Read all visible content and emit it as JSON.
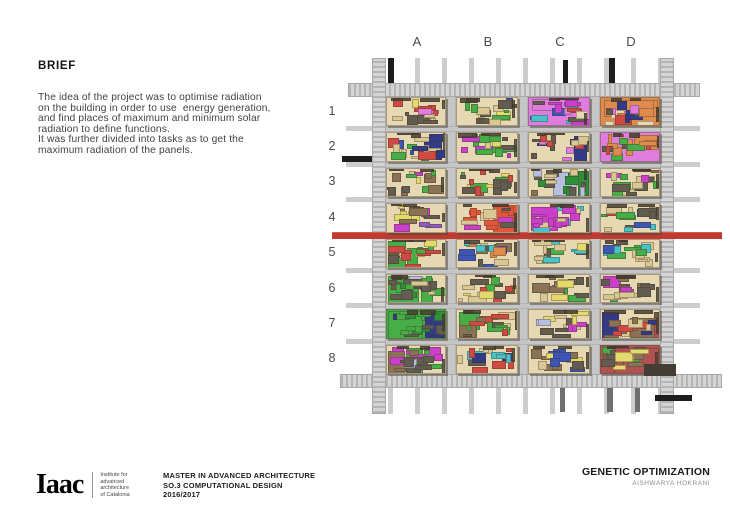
{
  "page": {
    "background": "#ffffff"
  },
  "brief": {
    "heading": "BRIEF",
    "lines": [
      "The idea of the project was to optimise radiation",
      "on the building in order to use  energy generation,",
      "and find places of maximum and minimum solar",
      "radiation to define functions.",
      "It was further divided into tasks as to get the",
      "maximum radiation of the panels."
    ]
  },
  "diagram": {
    "column_labels": [
      "A",
      "B",
      "C",
      "D"
    ],
    "row_labels": [
      "1",
      "2",
      "3",
      "4",
      "5",
      "6",
      "7",
      "8"
    ],
    "colors": {
      "road": "#c6c6c6",
      "road_hatch_dark": "#b5b5b5",
      "road_hatch_light": "#d4d4d4",
      "red_band": "#bf3a31",
      "cell_base": "#e7d8b4",
      "shadow": "#5e574c",
      "black_accent": "#1d1d1d"
    },
    "cells": [
      {
        "id": "A1",
        "base": "#e7d8b4",
        "palette": [
          "#635c50",
          "#cf4a42",
          "#e3d96d",
          "#de7dde",
          "#d9c794",
          "#635c50",
          "#cf4a42"
        ],
        "features": []
      },
      {
        "id": "B1",
        "base": "#e7d8b4",
        "palette": [
          "#d9c794",
          "#3d55b5",
          "#635c50",
          "#e3d96d",
          "#d9c794",
          "#47ad47"
        ],
        "features": []
      },
      {
        "id": "C1",
        "base": "#de7dde",
        "palette": [
          "#cc3fcc",
          "#49c3c9",
          "#3d55b5",
          "#635c50",
          "#de7dde",
          "#e7d8b4",
          "#cf4a42"
        ],
        "features": [
          {
            "x": 0.05,
            "y": 0.05,
            "w": 0.55,
            "h": 0.4,
            "c": "#de7dde",
            "s": 0
          }
        ]
      },
      {
        "id": "D1",
        "base": "#e08b4e",
        "palette": [
          "#e08b4e",
          "#333a85",
          "#cf4a42",
          "#635c50",
          "#e7d8b4",
          "#de7dde"
        ],
        "features": [
          {
            "x": 0.05,
            "y": 0.08,
            "w": 0.9,
            "h": 0.55,
            "c": "#e08b4e",
            "s": 0
          }
        ]
      },
      {
        "id": "A2",
        "base": "#e7d8b4",
        "palette": [
          "#333a85",
          "#3d55b5",
          "#cf4a42",
          "#47ad47",
          "#d9c794",
          "#635c50"
        ],
        "features": [
          {
            "x": 0.62,
            "y": 0.12,
            "w": 0.3,
            "h": 0.8,
            "c": "#333a85",
            "s": 1
          }
        ]
      },
      {
        "id": "B2",
        "base": "#e7d8b4",
        "palette": [
          "#cc3fcc",
          "#47ad47",
          "#e3d96d",
          "#d9c794",
          "#635c50",
          "#47ad47"
        ],
        "features": []
      },
      {
        "id": "C2",
        "base": "#e7d8b4",
        "palette": [
          "#de7dde",
          "#333a85",
          "#cf4a42",
          "#47ad47",
          "#d9c794",
          "#635c50"
        ],
        "features": [
          {
            "x": 0.72,
            "y": 0.08,
            "w": 0.22,
            "h": 0.85,
            "c": "#333a85",
            "s": 1
          }
        ]
      },
      {
        "id": "D2",
        "base": "#de7dde",
        "palette": [
          "#e08b4e",
          "#de7dde",
          "#47ad47",
          "#cf4a42",
          "#635c50"
        ],
        "features": [
          {
            "x": 0.55,
            "y": 0.05,
            "w": 0.42,
            "h": 0.5,
            "c": "#e08b4e",
            "s": 0
          }
        ]
      },
      {
        "id": "A3",
        "base": "#e7d8b4",
        "palette": [
          "#cc3fcc",
          "#47ad47",
          "#8a7257",
          "#d9c794",
          "#635c50",
          "#e3d96d"
        ],
        "features": []
      },
      {
        "id": "B3",
        "base": "#e7d8b4",
        "palette": [
          "#47ad47",
          "#cf4a42",
          "#e3d96d",
          "#d9c794",
          "#635c50"
        ],
        "features": []
      },
      {
        "id": "C3",
        "base": "#e7d8b4",
        "palette": [
          "#b7bedf",
          "#2f8f3a",
          "#8a7257",
          "#d9c794",
          "#635c50"
        ],
        "features": [
          {
            "x": 0.38,
            "y": 0.12,
            "w": 0.4,
            "h": 0.82,
            "c": "#b7bedf",
            "s": 0
          },
          {
            "x": 0.79,
            "y": 0.08,
            "w": 0.17,
            "h": 0.86,
            "c": "#2f8f3a",
            "s": 1
          }
        ]
      },
      {
        "id": "D3",
        "base": "#e7d8b4",
        "palette": [
          "#cc3fcc",
          "#47ad47",
          "#8a7257",
          "#635c50",
          "#d9c794"
        ],
        "features": []
      },
      {
        "id": "A4",
        "base": "#e7d8b4",
        "palette": [
          "#8f5bbf",
          "#cc3fcc",
          "#8a7257",
          "#e3d96d",
          "#635c50"
        ],
        "features": []
      },
      {
        "id": "B4",
        "base": "#e7d8b4",
        "palette": [
          "#e2573b",
          "#cc3fcc",
          "#d9c794",
          "#635c50"
        ],
        "features": [
          {
            "x": 0.58,
            "y": 0.02,
            "w": 0.44,
            "h": 0.96,
            "c": "#e2573b",
            "s": 0
          }
        ]
      },
      {
        "id": "C4",
        "base": "#e7d8b4",
        "palette": [
          "#cc3fcc",
          "#49c3c9",
          "#d9c794",
          "#635c50"
        ],
        "features": [
          {
            "x": 0.04,
            "y": 0.1,
            "w": 0.42,
            "h": 0.8,
            "c": "#cc3fcc",
            "s": 0
          },
          {
            "x": 0.06,
            "y": 0.72,
            "w": 0.28,
            "h": 0.26,
            "c": "#49c3c9",
            "s": 0
          }
        ]
      },
      {
        "id": "D4",
        "base": "#e7d8b4",
        "palette": [
          "#3d55b5",
          "#cf4a42",
          "#47ad47",
          "#49c3c9",
          "#d9c794",
          "#635c50"
        ],
        "features": []
      },
      {
        "id": "A5",
        "base": "#e7d8b4",
        "palette": [
          "#47ad47",
          "#cf4a42",
          "#e3d96d",
          "#d9c794",
          "#635c50"
        ],
        "features": [
          {
            "x": 0.02,
            "y": 0.04,
            "w": 0.3,
            "h": 0.94,
            "c": "#47ad47",
            "s": 1
          },
          {
            "x": 0.34,
            "y": 0.28,
            "w": 0.18,
            "h": 0.6,
            "c": "#47ad47",
            "s": 1
          }
        ]
      },
      {
        "id": "B5",
        "base": "#e7d8b4",
        "palette": [
          "#e08b4e",
          "#49c3c9",
          "#8a7257",
          "#3d55b5",
          "#d9c794",
          "#635c50"
        ],
        "features": []
      },
      {
        "id": "C5",
        "base": "#e7d8b4",
        "palette": [
          "#d9c794",
          "#e3d96d",
          "#47ad47",
          "#635c50",
          "#49c3c9"
        ],
        "features": []
      },
      {
        "id": "D5",
        "base": "#e7d8b4",
        "palette": [
          "#49c3c9",
          "#3d55b5",
          "#47ad47",
          "#d9c794",
          "#635c50"
        ],
        "features": []
      },
      {
        "id": "A6",
        "base": "#e7d8b4",
        "palette": [
          "#47ad47",
          "#2f8f3a",
          "#d9c794",
          "#635c50"
        ],
        "features": [
          {
            "x": 0.02,
            "y": 0.05,
            "w": 0.52,
            "h": 0.92,
            "c": "#47ad47",
            "s": 1
          },
          {
            "x": 0.36,
            "y": 0.04,
            "w": 0.24,
            "h": 0.3,
            "c": "#b7bedf",
            "s": 0
          },
          {
            "x": 0.56,
            "y": 0.1,
            "w": 0.2,
            "h": 0.85,
            "c": "#47ad47",
            "s": 1
          }
        ]
      },
      {
        "id": "B6",
        "base": "#e7d8b4",
        "palette": [
          "#cf4a42",
          "#e3d96d",
          "#47ad47",
          "#d9c794",
          "#635c50"
        ],
        "features": []
      },
      {
        "id": "C6",
        "base": "#e7d8b4",
        "palette": [
          "#e3d96d",
          "#d9c794",
          "#8a7257",
          "#635c50",
          "#47ad47"
        ],
        "features": []
      },
      {
        "id": "D6",
        "base": "#e7d8b4",
        "palette": [
          "#cc3fcc",
          "#47ad47",
          "#8a7257",
          "#d9c794",
          "#635c50"
        ],
        "features": [
          {
            "x": 0.04,
            "y": 0.04,
            "w": 0.3,
            "h": 0.4,
            "c": "#cc3fcc",
            "s": 0
          }
        ]
      },
      {
        "id": "A7",
        "base": "#47ad47",
        "palette": [
          "#47ad47",
          "#2f8f3a",
          "#333a85",
          "#635c50"
        ],
        "features": [
          {
            "x": 0.02,
            "y": 0.03,
            "w": 0.58,
            "h": 0.94,
            "c": "#47ad47",
            "s": 1
          },
          {
            "x": 0.64,
            "y": 0.05,
            "w": 0.32,
            "h": 0.9,
            "c": "#333a85",
            "s": 1
          }
        ]
      },
      {
        "id": "B7",
        "base": "#e7d8b4",
        "palette": [
          "#47ad47",
          "#8a7257",
          "#d9c794",
          "#635c50",
          "#cf4a42"
        ],
        "features": [
          {
            "x": 0.03,
            "y": 0.06,
            "w": 0.34,
            "h": 0.6,
            "c": "#47ad47",
            "s": 1
          },
          {
            "x": 0.03,
            "y": 0.5,
            "w": 0.3,
            "h": 0.46,
            "c": "#8a7257",
            "s": 0
          }
        ]
      },
      {
        "id": "C7",
        "base": "#e7d8b4",
        "palette": [
          "#cc3fcc",
          "#e3d96d",
          "#b7bedf",
          "#d9c794",
          "#635c50"
        ],
        "features": []
      },
      {
        "id": "D7",
        "base": "#e7d8b4",
        "palette": [
          "#333a85",
          "#8a7257",
          "#cf4a42",
          "#635c50",
          "#d9c794"
        ],
        "features": [
          {
            "x": 0.02,
            "y": 0.05,
            "w": 0.28,
            "h": 0.9,
            "c": "#333a85",
            "s": 1
          },
          {
            "x": 0.48,
            "y": 0.28,
            "w": 0.46,
            "h": 0.68,
            "c": "#8a7257",
            "s": 0
          },
          {
            "x": 0.88,
            "y": 0.05,
            "w": 0.1,
            "h": 0.9,
            "c": "#b05252",
            "s": 0
          }
        ]
      },
      {
        "id": "A8",
        "base": "#e7d8b4",
        "palette": [
          "#8a7257",
          "#47ad47",
          "#cc3fcc",
          "#b7bedf",
          "#635c50"
        ],
        "features": [
          {
            "x": 0.02,
            "y": 0.18,
            "w": 0.28,
            "h": 0.78,
            "c": "#8a7257",
            "s": 0
          },
          {
            "x": 0.32,
            "y": 0.08,
            "w": 0.28,
            "h": 0.88,
            "c": "#47ad47",
            "s": 1
          },
          {
            "x": 0.62,
            "y": 0.04,
            "w": 0.28,
            "h": 0.34,
            "c": "#cc3fcc",
            "s": 0
          }
        ]
      },
      {
        "id": "B8",
        "base": "#e7d8b4",
        "palette": [
          "#cf4a42",
          "#333a85",
          "#49c3c9",
          "#d9c794",
          "#635c50",
          "#e3d96d"
        ],
        "features": []
      },
      {
        "id": "C8",
        "base": "#e7d8b4",
        "palette": [
          "#e3d96d",
          "#3d55b5",
          "#8a7257",
          "#d9c794",
          "#635c50"
        ],
        "features": []
      },
      {
        "id": "D8",
        "base": "#b05252",
        "palette": [
          "#b05252",
          "#8a7257",
          "#47ad47",
          "#e3d96d",
          "#635c50"
        ],
        "features": [
          {
            "x": 0.22,
            "y": 0.08,
            "w": 0.74,
            "h": 0.88,
            "c": "#b05252",
            "s": 1
          },
          {
            "x": 0.02,
            "y": 0.04,
            "w": 0.2,
            "h": 0.3,
            "c": "#47ad47",
            "s": 1
          }
        ]
      }
    ]
  },
  "footer": {
    "logo_text": "Iaac",
    "logo_sub_lines": [
      "Institute for",
      "advanced",
      "architecture",
      "of Catalonia"
    ],
    "program_lines": [
      "MASTER IN ADVANCED ARCHITECTURE",
      "SO.3 COMPUTATIONAL DESIGN",
      "2016/2017"
    ],
    "project_title": "GENETIC OPTIMIZATION",
    "author": "AISHWARYA HOKRANI"
  }
}
